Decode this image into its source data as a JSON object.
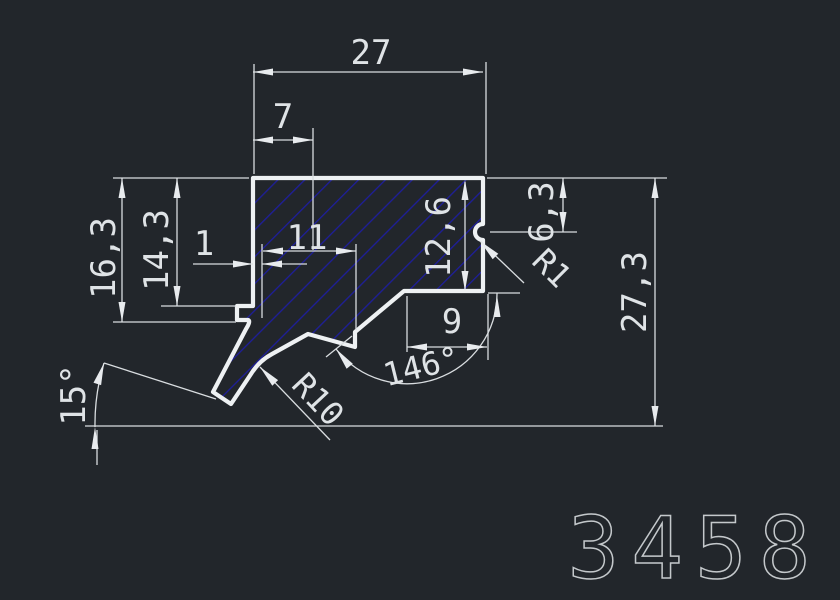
{
  "drawing": {
    "type": "cad-profile-cross-section",
    "part_number": "3458",
    "colors": {
      "background": "#22262b",
      "profile_outline": "#eef1f3",
      "dimension_lines": "#d9dde0",
      "hatch": "#1e1e9c",
      "dimension_text": "#dfe3e6",
      "part_number_text": "#c4c8cb"
    },
    "dimensions": {
      "top_width": "27",
      "top_offset": "7",
      "inner_width": "11",
      "edge_offset": "1",
      "left_outer_depth": "16,3",
      "left_inner_depth": "14,3",
      "right_depth": "12,6",
      "notch_offset": "6,3",
      "total_height": "27,3",
      "bottom_width": "9",
      "bottom_angle": "146°",
      "leg_angle": "15°",
      "notch_radius": "R1",
      "leg_radius": "R10"
    }
  }
}
